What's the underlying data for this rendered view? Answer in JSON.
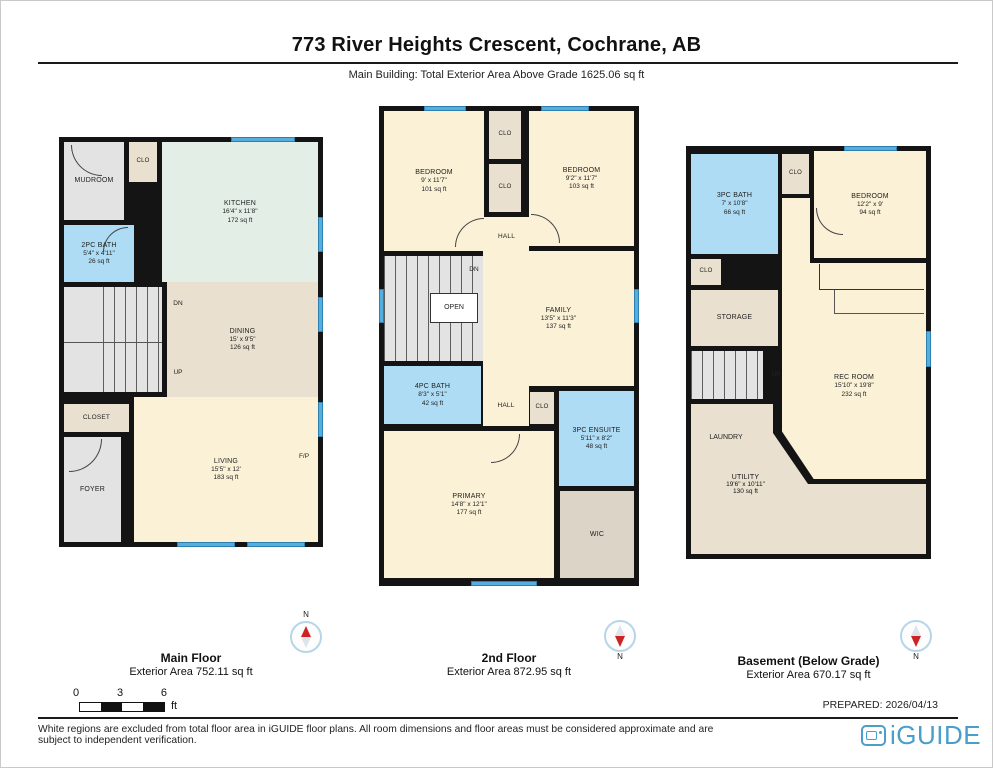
{
  "header": {
    "title": "773 River Heights Crescent, Cochrane, AB",
    "subtitle": "Main Building: Total Exterior Area Above Grade 1625.06 sq ft"
  },
  "floors": [
    {
      "label": "Main Floor",
      "area_label": "Exterior Area 752.11 sq ft",
      "compass_n": "N",
      "rooms": [
        {
          "name": "MUDROOM"
        },
        {
          "name": "CLO"
        },
        {
          "name": "KITCHEN",
          "dims": "16'4\" x 11'8\"",
          "area": "172 sq ft"
        },
        {
          "name": "2PC BATH",
          "dims": "5'4\" x 4'11\"",
          "area": "26 sq ft"
        },
        {
          "name": "DINING",
          "dims": "15' x 9'5\"",
          "area": "126 sq ft"
        },
        {
          "name": "CLOSET"
        },
        {
          "name": "FOYER"
        },
        {
          "name": "LIVING",
          "dims": "15'5\" x 12'",
          "area": "183 sq ft"
        }
      ],
      "annotations": {
        "dn": "DN",
        "up": "UP",
        "fp": "F/P"
      }
    },
    {
      "label": "2nd Floor",
      "area_label": "Exterior Area 872.95 sq ft",
      "compass_n": "N",
      "rooms": [
        {
          "name": "BEDROOM",
          "dims": "9' x 11'7\"",
          "area": "101 sq ft"
        },
        {
          "name": "CLO"
        },
        {
          "name": "CLO"
        },
        {
          "name": "BEDROOM",
          "dims": "9'2\" x 11'7\"",
          "area": "103 sq ft"
        },
        {
          "name": "HALL"
        },
        {
          "name": "FAMILY",
          "dims": "13'5\" x 11'3\"",
          "area": "137 sq ft"
        },
        {
          "name": "4PC BATH",
          "dims": "8'3\" x 5'1\"",
          "area": "42 sq ft"
        },
        {
          "name": "HALL"
        },
        {
          "name": "CLO"
        },
        {
          "name": "3PC ENSUITE",
          "dims": "5'11\" x 8'2\"",
          "area": "48 sq ft"
        },
        {
          "name": "PRIMARY",
          "dims": "14'8\" x 12'1\"",
          "area": "177 sq ft"
        },
        {
          "name": "WIC"
        }
      ],
      "annotations": {
        "dn": "DN",
        "open": "OPEN"
      }
    },
    {
      "label": "Basement (Below Grade)",
      "area_label": "Exterior Area 670.17 sq ft",
      "compass_n": "N",
      "rooms": [
        {
          "name": "3PC BATH",
          "dims": "7' x 10'8\"",
          "area": "66 sq ft"
        },
        {
          "name": "CLO"
        },
        {
          "name": "BEDROOM",
          "dims": "12'2\" x 9'",
          "area": "94 sq ft"
        },
        {
          "name": "CLO"
        },
        {
          "name": "STORAGE"
        },
        {
          "name": "REC ROOM",
          "dims": "15'10\" x 19'8\"",
          "area": "232 sq ft"
        },
        {
          "name": "LAUNDRY"
        },
        {
          "name": "UTILITY",
          "dims": "19'6\" x 10'11\"",
          "area": "130 sq ft"
        }
      ],
      "annotations": {
        "up": "UP"
      }
    }
  ],
  "scale_bar": {
    "ticks": [
      "0",
      "3",
      "6"
    ],
    "unit": "ft"
  },
  "footer": {
    "prepared": "PREPARED: 2026/04/13",
    "disclaimer": "White regions are excluded from total floor area in iGUIDE floor plans. All room dimensions and floor areas must be considered approximate and are subject to independent verification.",
    "brand": "iGUIDE"
  }
}
